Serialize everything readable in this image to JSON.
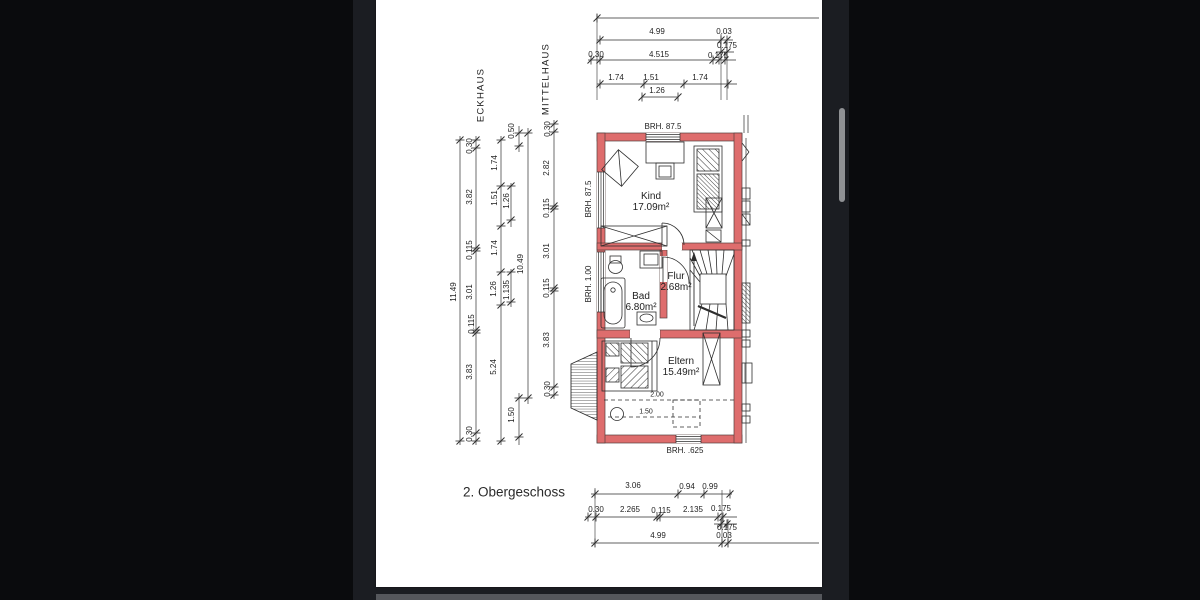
{
  "window": {
    "title_label": "2. Obergeschoss"
  },
  "palette": {
    "background": "#0a0b0d",
    "viewer_chrome": "#1b1d22",
    "page": "#ffffff",
    "next_page_sliver": "#55575c",
    "scroll_thumb": "#8f9194",
    "wall_red": "#de6d6d",
    "line": "#2e2e2e"
  },
  "floorplan": {
    "house_labels": [
      {
        "text": "ECKHAUS",
        "x": 481,
        "y": 95,
        "rot": -90
      },
      {
        "text": "MITTELHAUS",
        "x": 546,
        "y": 79,
        "rot": -90
      }
    ],
    "rooms": [
      {
        "name": "Kind",
        "area": "17.09m²",
        "x": 651,
        "y": 197
      },
      {
        "name": "Flur",
        "area": "2.68m²",
        "x": 676,
        "y": 277
      },
      {
        "name": "Bad",
        "area": "6.80m²",
        "x": 641,
        "y": 297
      },
      {
        "name": "Eltern",
        "area": "15.49m²",
        "x": 681,
        "y": 362
      }
    ],
    "sill_labels": [
      {
        "text": "BRH. 87.5",
        "x": 663,
        "y": 127,
        "rot": 0
      },
      {
        "text": "BRH. 87.5",
        "x": 589,
        "y": 199,
        "rot": -90
      },
      {
        "text": "BRH. 1.00",
        "x": 589,
        "y": 284,
        "rot": -90
      },
      {
        "text": "BRH. .625",
        "x": 685,
        "y": 451,
        "rot": 0
      }
    ],
    "roof_labels": [
      {
        "text": "2.00",
        "x": 657,
        "y": 395
      },
      {
        "text": "1.50",
        "x": 646,
        "y": 412
      }
    ]
  },
  "dimensions": {
    "top": [
      {
        "text": "4.99",
        "x": 657,
        "y": 32
      },
      {
        "text": "0.03",
        "x": 724,
        "y": 32
      },
      {
        "text": "0.30",
        "x": 596,
        "y": 55
      },
      {
        "text": "4.515",
        "x": 659,
        "y": 55
      },
      {
        "text": "0.175",
        "x": 727,
        "y": 46
      },
      {
        "text": "0.175",
        "x": 718,
        "y": 56
      },
      {
        "text": "1.74",
        "x": 616,
        "y": 78
      },
      {
        "text": "1.51",
        "x": 651,
        "y": 78
      },
      {
        "text": "1.74",
        "x": 700,
        "y": 78
      },
      {
        "text": "1.26",
        "x": 657,
        "y": 91
      }
    ],
    "left": [
      {
        "text": "11.49",
        "x": 454,
        "y": 292,
        "rot": -90
      },
      {
        "text": "0.30",
        "x": 470,
        "y": 146,
        "rot": -90
      },
      {
        "text": "3.82",
        "x": 470,
        "y": 197,
        "rot": -90
      },
      {
        "text": "0.115",
        "x": 470,
        "y": 250,
        "rot": -90
      },
      {
        "text": "3.01",
        "x": 470,
        "y": 292,
        "rot": -90
      },
      {
        "text": "0.115",
        "x": 472,
        "y": 324,
        "rot": -90
      },
      {
        "text": "3.83",
        "x": 470,
        "y": 372,
        "rot": -90
      },
      {
        "text": "0.30",
        "x": 470,
        "y": 434,
        "rot": -90
      },
      {
        "text": "1.74",
        "x": 495,
        "y": 163,
        "rot": -90
      },
      {
        "text": "1.51",
        "x": 495,
        "y": 198,
        "rot": -90
      },
      {
        "text": "1.74",
        "x": 495,
        "y": 248,
        "rot": -90
      },
      {
        "text": "1.26",
        "x": 494,
        "y": 289,
        "rot": -90
      },
      {
        "text": "5.24",
        "x": 494,
        "y": 367,
        "rot": -90
      },
      {
        "text": "1.26",
        "x": 507,
        "y": 201,
        "rot": -90
      },
      {
        "text": "1.135",
        "x": 507,
        "y": 290,
        "rot": -90
      },
      {
        "text": "0.50",
        "x": 512,
        "y": 131,
        "rot": -90
      },
      {
        "text": "1.50",
        "x": 512,
        "y": 415,
        "rot": -90
      },
      {
        "text": "10.49",
        "x": 521,
        "y": 264,
        "rot": -90
      },
      {
        "text": "0.30",
        "x": 548,
        "y": 129,
        "rot": -90
      },
      {
        "text": "2.82",
        "x": 547,
        "y": 168,
        "rot": -90
      },
      {
        "text": "0.115",
        "x": 547,
        "y": 208,
        "rot": -90
      },
      {
        "text": "3.01",
        "x": 547,
        "y": 251,
        "rot": -90
      },
      {
        "text": "0.115",
        "x": 547,
        "y": 288,
        "rot": -90
      },
      {
        "text": "3.83",
        "x": 547,
        "y": 340,
        "rot": -90
      },
      {
        "text": "0.30",
        "x": 548,
        "y": 389,
        "rot": -90
      }
    ],
    "bottom": [
      {
        "text": "3.06",
        "x": 633,
        "y": 486
      },
      {
        "text": "0.94",
        "x": 687,
        "y": 487
      },
      {
        "text": "0.99",
        "x": 710,
        "y": 487
      },
      {
        "text": "0.30",
        "x": 596,
        "y": 510
      },
      {
        "text": "2.265",
        "x": 630,
        "y": 510
      },
      {
        "text": "0.115",
        "x": 661,
        "y": 511
      },
      {
        "text": "2.135",
        "x": 693,
        "y": 510
      },
      {
        "text": "0.175",
        "x": 721,
        "y": 509
      },
      {
        "text": "0.175",
        "x": 727,
        "y": 528
      },
      {
        "text": "4.99",
        "x": 658,
        "y": 536
      },
      {
        "text": "0.03",
        "x": 724,
        "y": 536
      }
    ]
  }
}
